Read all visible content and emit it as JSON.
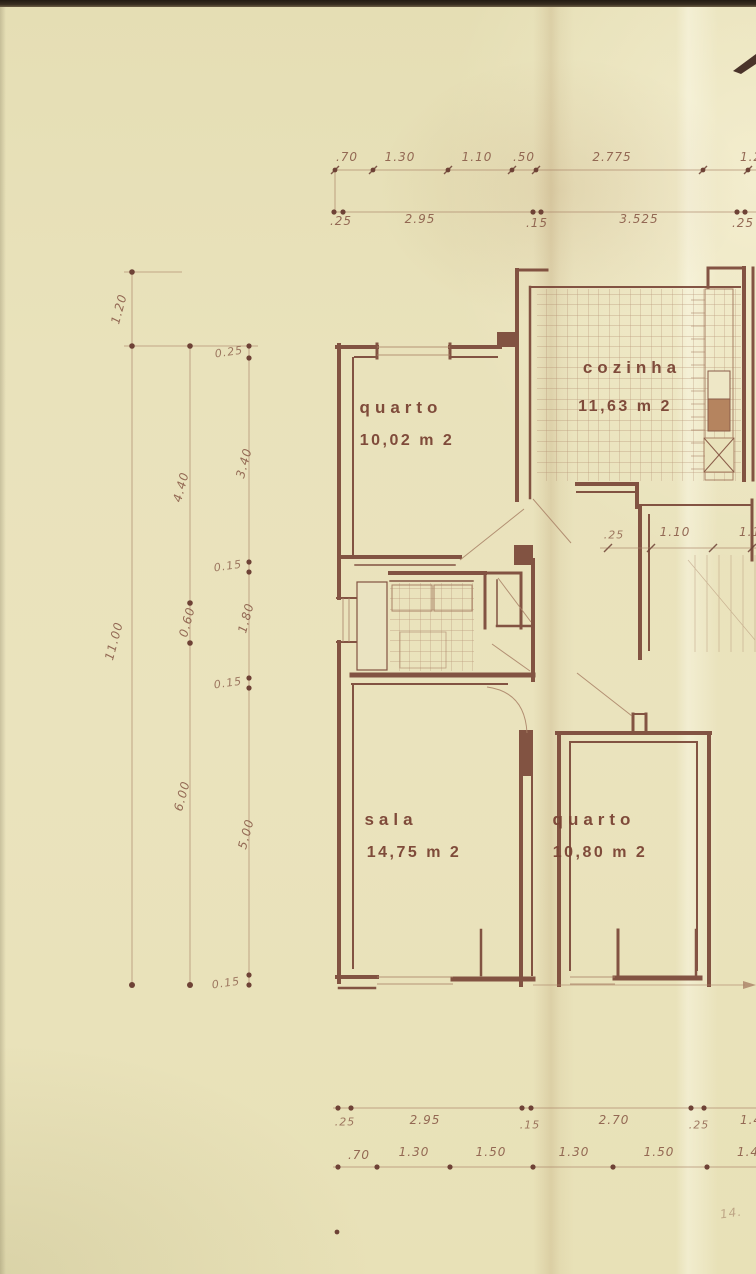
{
  "colors": {
    "paper": "#e9e2bb",
    "ink": "#7a4738",
    "ink_light": "#a98166",
    "text": "#8a5c49"
  },
  "rooms": [
    {
      "name": "quarto",
      "area": "10,02 m 2"
    },
    {
      "name": "cozinha",
      "area": "11,63 m 2"
    },
    {
      "name": "sala",
      "area": "14,75 m 2"
    },
    {
      "name": "quarto",
      "area": "10,80 m 2"
    }
  ],
  "dims": {
    "top1": [
      ".70",
      "1.30",
      "1.10",
      ".50",
      "2.775",
      "1.2"
    ],
    "top2": [
      ".25",
      "2.95",
      ".15",
      "3.525",
      ".25"
    ],
    "left_a": [
      "1.20",
      "11.00"
    ],
    "left_b": [
      "4.40",
      "0.60",
      "6.00"
    ],
    "left_c": [
      "0.25",
      "3.40",
      "0.15",
      "1.80",
      "0.15",
      "5.00",
      "0.15"
    ],
    "hall": [
      ".25",
      "1.10",
      "1.1"
    ],
    "bottom1": [
      ".25",
      "2.95",
      ".15",
      "2.70",
      ".25",
      "1.4"
    ],
    "bottom2": [
      ".70",
      "1.30",
      "1.50",
      "1.30",
      "1.50",
      "1.4"
    ],
    "footnote": "14."
  }
}
